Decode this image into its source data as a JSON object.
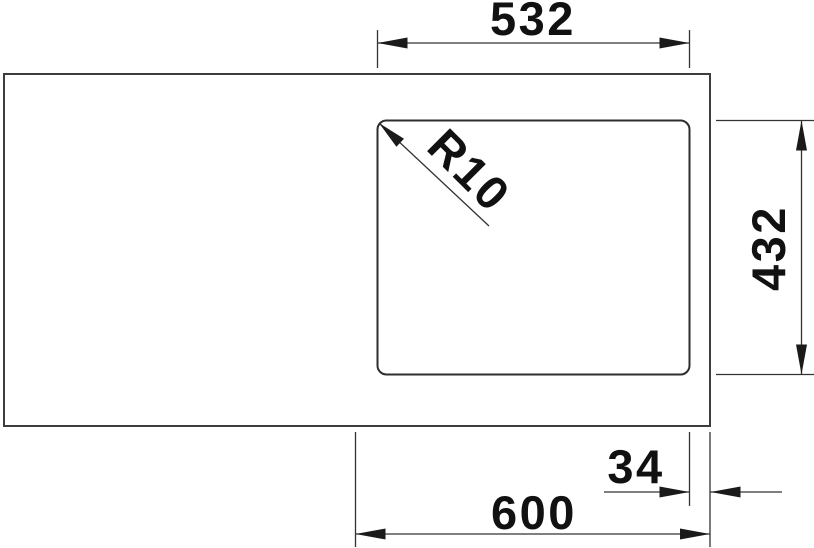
{
  "drawing": {
    "kind": "sink-top-view-dimension-drawing",
    "dimensions": {
      "bowl_width": "532",
      "bowl_depth": "432",
      "corner_radius": "R10",
      "rim_offset": "34",
      "cabinet_width": "600"
    },
    "colors": {
      "background": "#ffffff",
      "outline": "#3d3d3d",
      "dimension_line": "#333333",
      "text": "#111111"
    }
  }
}
